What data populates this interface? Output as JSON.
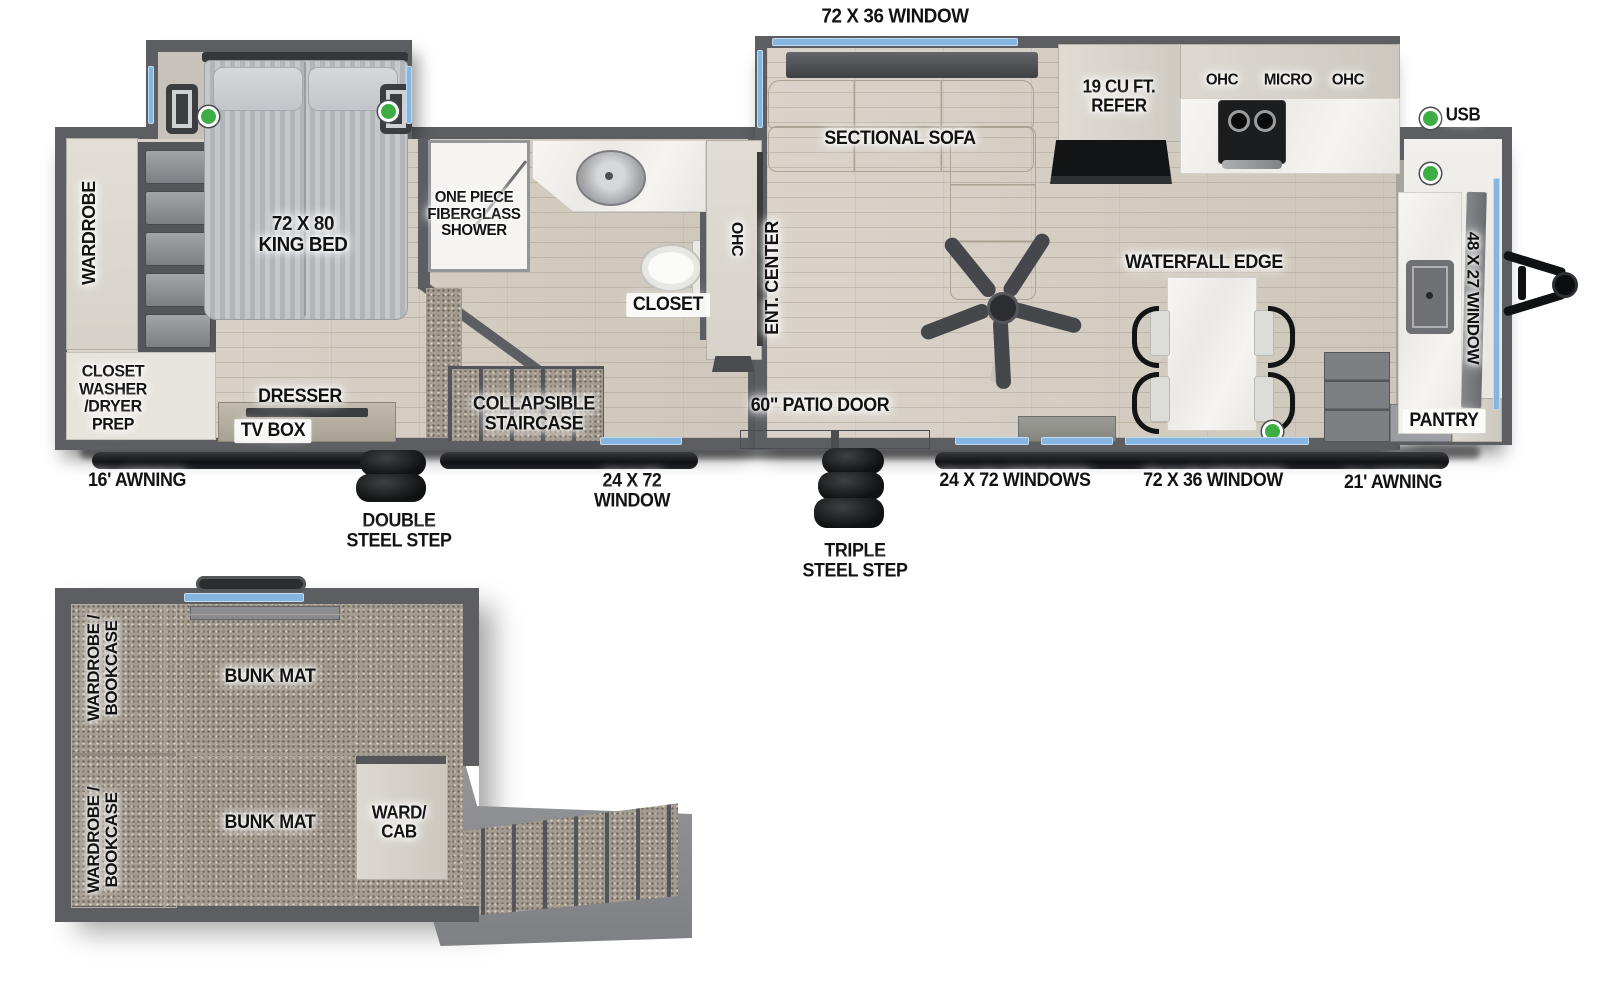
{
  "colors": {
    "wall": "#5d5e62",
    "window": "#85b5e1",
    "usb_green": "#3cae44",
    "awning": "#141517"
  },
  "plan": {
    "top": {
      "window_top": "72 X 36 WINDOW",
      "usb": "USB"
    },
    "bedroom": {
      "wardrobe": "WARDROBE",
      "king_bed": "72 X 80\nKING BED",
      "closet_wd": "CLOSET\nWASHER\n/DRYER\nPREP",
      "dresser": "DRESSER",
      "tv_box": "TV BOX"
    },
    "bath": {
      "shower": "ONE PIECE\nFIBERGLASS\nSHOWER",
      "closet": "CLOSET"
    },
    "living": {
      "ohc": "OHC",
      "ent_center": "ENT. CENTER",
      "sofa": "SECTIONAL SOFA"
    },
    "kitchen": {
      "refer": "19 CU FT.\nREFER",
      "ohc_left": "OHC",
      "micro": "MICRO",
      "ohc_right": "OHC",
      "waterfall": "WATERFALL EDGE",
      "pantry": "PANTRY"
    },
    "front": {
      "window_48x27": "48 X 27 WINDOW"
    },
    "mid": {
      "staircase": "COLLAPSIBLE\nSTAIRCASE",
      "patio_door": "60\" PATIO DOOR"
    },
    "bottom": {
      "awning16": "16' AWNING",
      "double_step": "DOUBLE\nSTEEL STEP",
      "window24": "24 X 72\nWINDOW",
      "triple_step": "TRIPLE\nSTEEL STEP",
      "windows24": "24 X 72 WINDOWS",
      "window72": "72 X 36 WINDOW",
      "awning21": "21' AWNING"
    }
  },
  "bunk": {
    "wardrobe1": "WARDROBE /\nBOOKCASE",
    "wardrobe2": "WARDROBE /\nBOOKCASE",
    "mat1": "BUNK MAT",
    "mat2": "BUNK MAT",
    "ward_cab": "WARD/\nCAB"
  }
}
